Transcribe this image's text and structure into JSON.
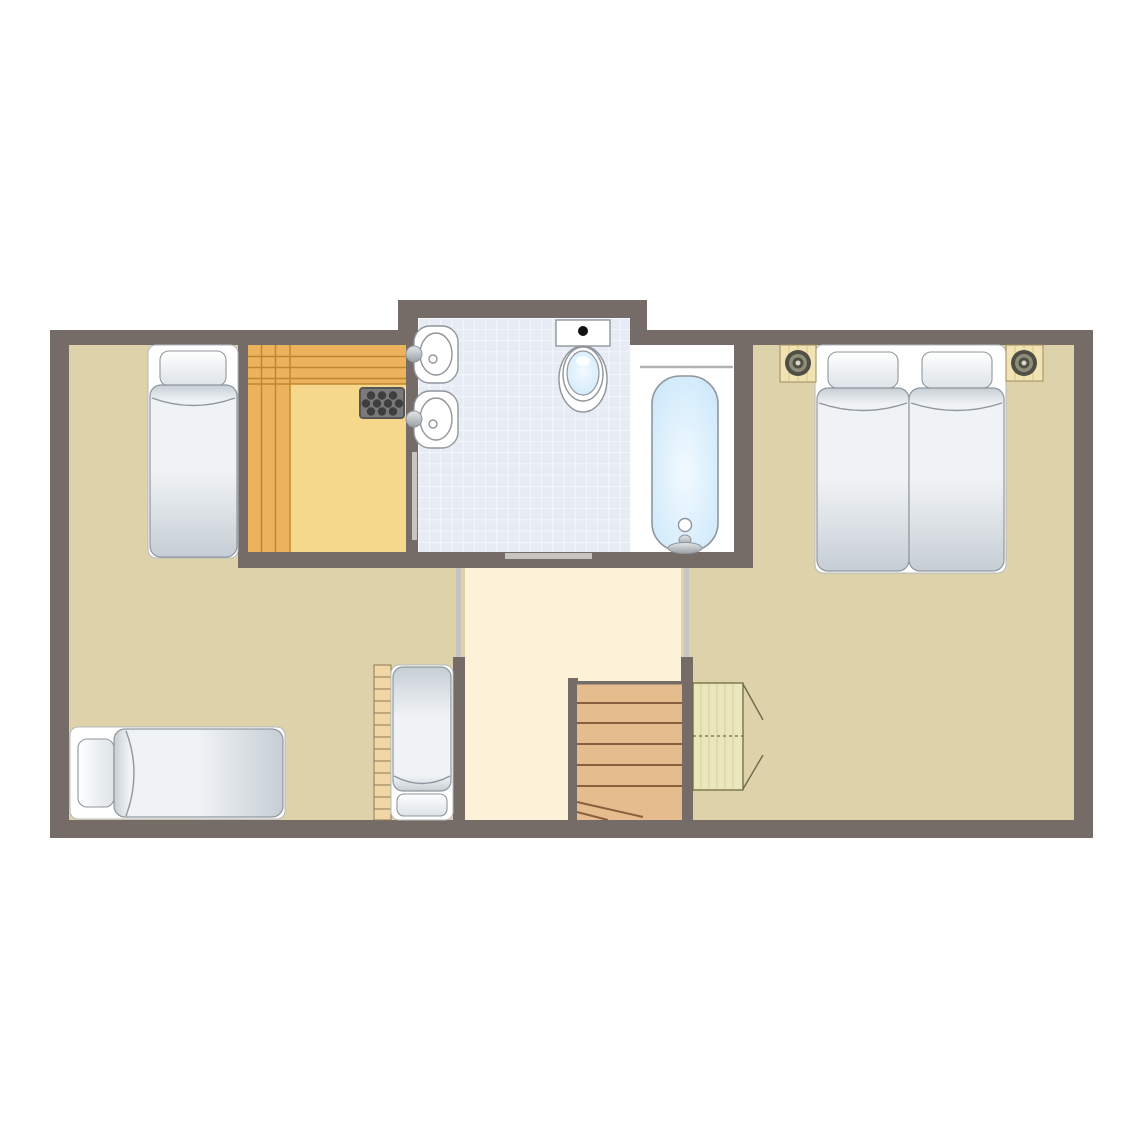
{
  "meta": {
    "kind": "architectural-floor-plan",
    "orientation": "top-down",
    "text_visible": "none"
  },
  "colors": {
    "page_bg": "#ffffff",
    "wall": "#756c67",
    "floor_tan": "#ded2ab",
    "floor_cream": "#fbf2d7",
    "tile": "#e6ebf4",
    "tile_grid": "#ffffff",
    "alcove": "#ffffff",
    "sauna_floor": "#f6d88c",
    "sauna_bench": "#ecb25c",
    "sauna_grain": "#bd872f",
    "heater_body": "#7a7a7a",
    "heater_border": "#565656",
    "heater_stones": "#3e3e3e",
    "stair_wood": "#e5bc8e",
    "stair_line": "#8a5f3f",
    "ladder_wood": "#f0d7a5",
    "ladder_line": "#8d7a5a",
    "wardrobe_fill": "#ebe7bd",
    "wardrobe_grain": "#d9d3a0",
    "wardrobe_line": "#6f6a45",
    "door_leaf": "#c7c4c1",
    "bed_base": "#ffffff",
    "bed_base_line": "#b4bac0",
    "duvet_light": "#f0f3f5",
    "duvet_dark": "#c6ced5",
    "duvet_line": "#8f969c",
    "pillow_light": "#ffffff",
    "pillow_dark": "#dde3e7",
    "water_light": "#f2faff",
    "water_deep": "#c8e6fa",
    "fixture_line": "#8f969c",
    "metal_light": "#e4e7e9",
    "metal_dark": "#9aa1a6",
    "shelf_line": "#b2b2b2",
    "lamp_outer": "#4f4f45",
    "lamp_mid": "#8e8e78",
    "lamp_center": "#d8d8c8",
    "nightstand_wood": "#f2e3b4",
    "nightstand_grain": "#dcc98f",
    "nightstand_line": "#9c8a5c"
  },
  "rooms": [
    {
      "id": "bedroom-left",
      "floor": "tan",
      "furniture": [
        "single-bed-top-left",
        "single-bed-bottom-left",
        "single-bed-with-ladder"
      ]
    },
    {
      "id": "sauna",
      "floor": "wood",
      "furniture": [
        "bench-top",
        "bench-left",
        "sauna-heater"
      ]
    },
    {
      "id": "bathroom",
      "floor": "tile",
      "furniture": [
        "washbasin-1",
        "washbasin-2",
        "toilet",
        "bathtub"
      ]
    },
    {
      "id": "hallway",
      "floor": "cream",
      "furniture": [
        "staircase"
      ]
    },
    {
      "id": "bedroom-right",
      "floor": "tan",
      "furniture": [
        "twin-bed-left",
        "twin-bed-right",
        "nightstand-left",
        "nightstand-right",
        "wardrobe"
      ]
    }
  ],
  "doors": [
    {
      "id": "sauna-door",
      "type": "sliding-leaf"
    },
    {
      "id": "bathroom-door",
      "type": "sliding-leaf"
    },
    {
      "id": "hallway-left-door",
      "type": "sliding-leaf"
    },
    {
      "id": "hallway-right-door",
      "type": "sliding-leaf"
    }
  ],
  "counts": {
    "beds": 5,
    "washbasins": 2,
    "toilets": 1,
    "bathtubs": 1,
    "lamps": 2,
    "stair_treads": 6
  }
}
